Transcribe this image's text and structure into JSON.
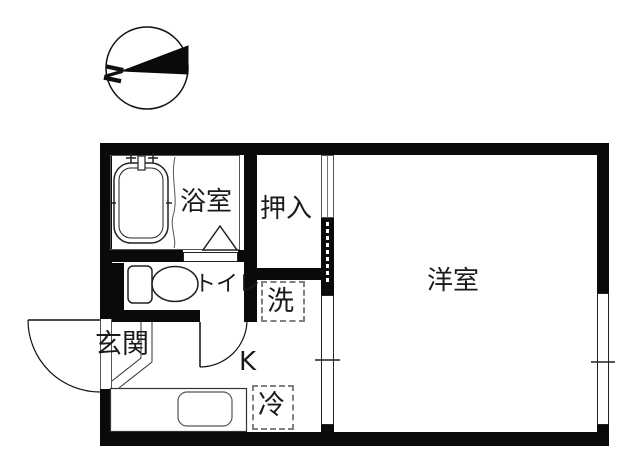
{
  "compass": {
    "north_label": "N"
  },
  "rooms": {
    "bathroom": {
      "label": "浴室"
    },
    "closet": {
      "label": "押入"
    },
    "western_room": {
      "label": "洋室"
    },
    "toilet": {
      "label": "トイレ"
    },
    "entrance": {
      "label": "玄関"
    },
    "kitchen": {
      "label": "K"
    },
    "washing_machine": {
      "label": "洗"
    },
    "refrigerator": {
      "label": "冷"
    }
  },
  "colors": {
    "wall": "#0a0a0a",
    "fixture_line": "#333333",
    "dashed_outline": "#808080",
    "background": "#ffffff",
    "text": "#1a1a1a"
  }
}
